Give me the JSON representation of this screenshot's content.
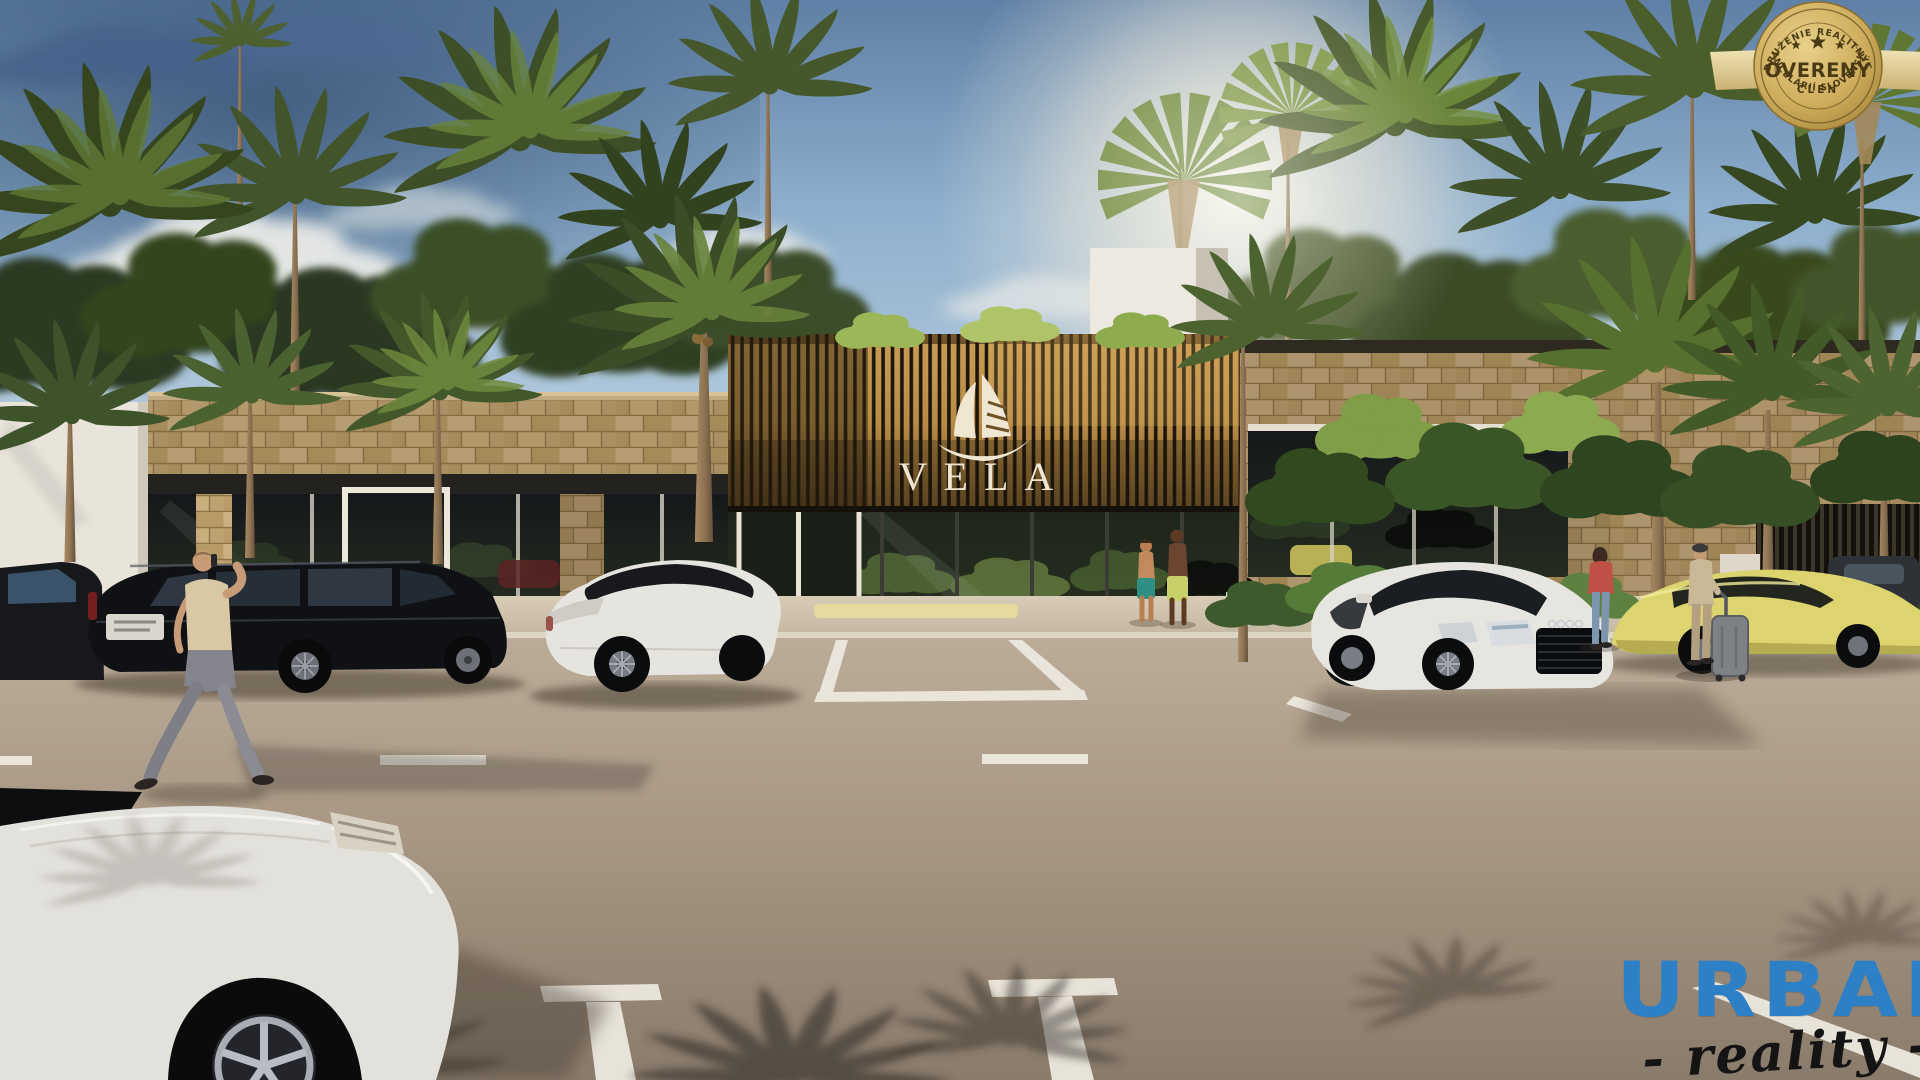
{
  "badge": {
    "arc_top": "ZDRUŽENIE REALITNÝCH",
    "arc_bottom": "KANCELÁRIÍ SLOVENSKA",
    "title": "OVERENÝ",
    "subtitle": "ČLEN",
    "stars_count": 3,
    "gold_color": "#C9A84C"
  },
  "signage": {
    "building_name": "VELA",
    "logo": "sailboat",
    "text_color": "#EFE5D0"
  },
  "watermark": {
    "brand": "URBAN",
    "tagline": "- reality -",
    "brand_color": "#2E80C6",
    "tagline_color": "#141414"
  }
}
